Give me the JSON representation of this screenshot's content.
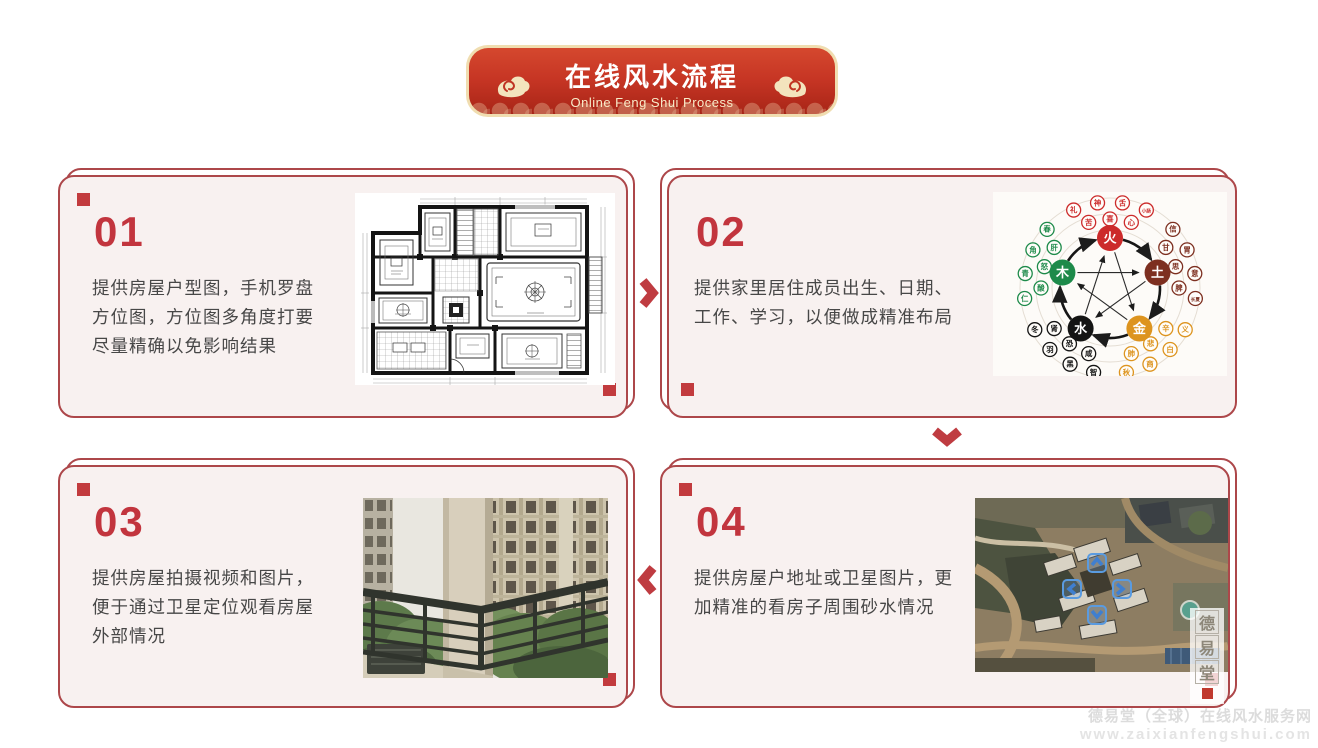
{
  "header": {
    "title": "在线风水流程",
    "subtitle": "Online Feng Shui Process"
  },
  "steps": [
    {
      "number": "01",
      "lines": [
        "提供房屋户型图，手机罗盘",
        "方位图，方位图多角度打要",
        "尽量精确以免影响结果"
      ],
      "image": "apartment-floor-plan"
    },
    {
      "number": "02",
      "lines": [
        "提供家里居住成员出生、日期、",
        "工作、学习，以便做成精准布局",
        ""
      ],
      "image": "five-elements-wuxing-diagram"
    },
    {
      "number": "03",
      "lines": [
        "提供房屋拍摄视频和图片，",
        "便于通过卫星定位观看房屋",
        "外部情况"
      ],
      "image": "balcony-exterior-photo"
    },
    {
      "number": "04",
      "lines": [
        "提供房屋户地址或卫星图片，更",
        "加精准的看房子周围砂水情况",
        ""
      ],
      "image": "satellite-map-photo"
    }
  ],
  "flow_arrows": [
    {
      "from": "01",
      "to": "02",
      "direction": "right"
    },
    {
      "from": "02",
      "to": "04",
      "direction": "down"
    },
    {
      "from": "04",
      "to": "03",
      "direction": "left"
    }
  ],
  "five_elements": {
    "elements": [
      {
        "char": "火",
        "color": "#cc2b2b",
        "angle": -90,
        "satellites": [
          "苦",
          "喜",
          "心",
          "礼",
          "神",
          "舌",
          "小肠"
        ]
      },
      {
        "char": "土",
        "color": "#7d2f20",
        "angle": -18,
        "satellites": [
          "甘",
          "思",
          "脾",
          "信",
          "胃",
          "意",
          "长夏"
        ]
      },
      {
        "char": "金",
        "color": "#dd941f",
        "angle": 54,
        "satellites": [
          "辛",
          "悲",
          "肺",
          "义",
          "白",
          "商",
          "秋"
        ]
      },
      {
        "char": "水",
        "color": "#141414",
        "angle": 126,
        "satellites": [
          "咸",
          "恐",
          "肾",
          "智",
          "黑",
          "羽",
          "冬"
        ]
      },
      {
        "char": "木",
        "color": "#1d8a4a",
        "angle": 198,
        "satellites": [
          "酸",
          "怒",
          "肝",
          "仁",
          "青",
          "角",
          "春"
        ]
      }
    ]
  },
  "seal_watermark": {
    "chars": [
      "德",
      "易",
      "堂"
    ],
    "accent": "#c0392e"
  },
  "site_watermark": {
    "line1": "德易堂（全球）在线风水服务网",
    "line2": "www.zaixianfengshui.com"
  },
  "colors": {
    "card_border": "#ad474a",
    "card_background": "#f8f1f0",
    "accent_red": "#c23b3e",
    "banner_red": "#c63524",
    "banner_border_gold": "#f0ddb0",
    "body_text": "#474747",
    "watermark_gray": "#dcdcdc"
  }
}
